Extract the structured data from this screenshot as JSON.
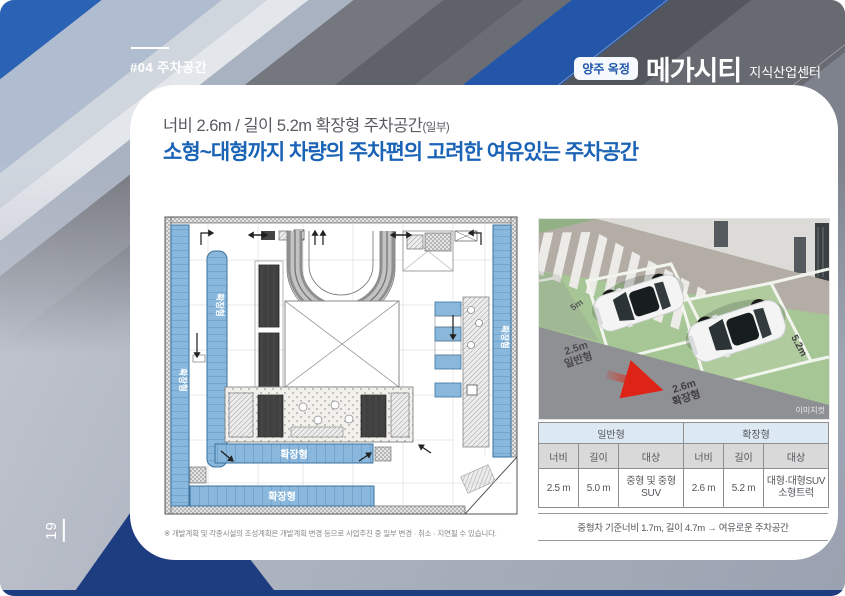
{
  "header": {
    "section_tag": "#04 주차공간",
    "brand_badge": "양주 옥정",
    "brand_name": "메가시티",
    "brand_suffix": "지식산업센터"
  },
  "headline": {
    "line1": "너비 2.6m / 길이 5.2m 확장형 주차공간",
    "line1_small": "(일부)",
    "line2": "소형~대형까지 차량의 주차편의 고려한 여유있는 주차공간"
  },
  "floorplan": {
    "expanded_label": "확장형",
    "footnote": "※ 개발계획 및 각종시설의 조성계획은 개발계획 변경 등으로 사업추진 중 일부 변경 · 취소 · 지연될 수 있습니다."
  },
  "photo": {
    "aisle_width": "5m",
    "general_width": "2.5m",
    "general_label": "일반형",
    "expanded_width": "2.6m",
    "expanded_label": "확장형",
    "length_label": "5.2m",
    "watermark": "이미지컷"
  },
  "spec_table": {
    "groups": [
      "일반형",
      "확장형"
    ],
    "columns": [
      "너비",
      "길이",
      "대상",
      "너비",
      "길이",
      "대상"
    ],
    "row": [
      "2.5 m",
      "5.0 m",
      "중형 및 중형 SUV",
      "2.6 m",
      "5.2 m",
      "대형·대형SUV 소형트럭"
    ],
    "note": "중형차 기준너비 1.7m, 길이 4.7m → 여유로운 주차공간"
  },
  "page": {
    "number": "19"
  },
  "colors": {
    "accent_blue": "#1a63b6",
    "navy": "#1e3c80",
    "stall_blue": "#8ab8dc",
    "table_header_blue": "#dce8f2",
    "table_header_gray": "#d9d9d9",
    "arrow_red": "#dd2417"
  }
}
